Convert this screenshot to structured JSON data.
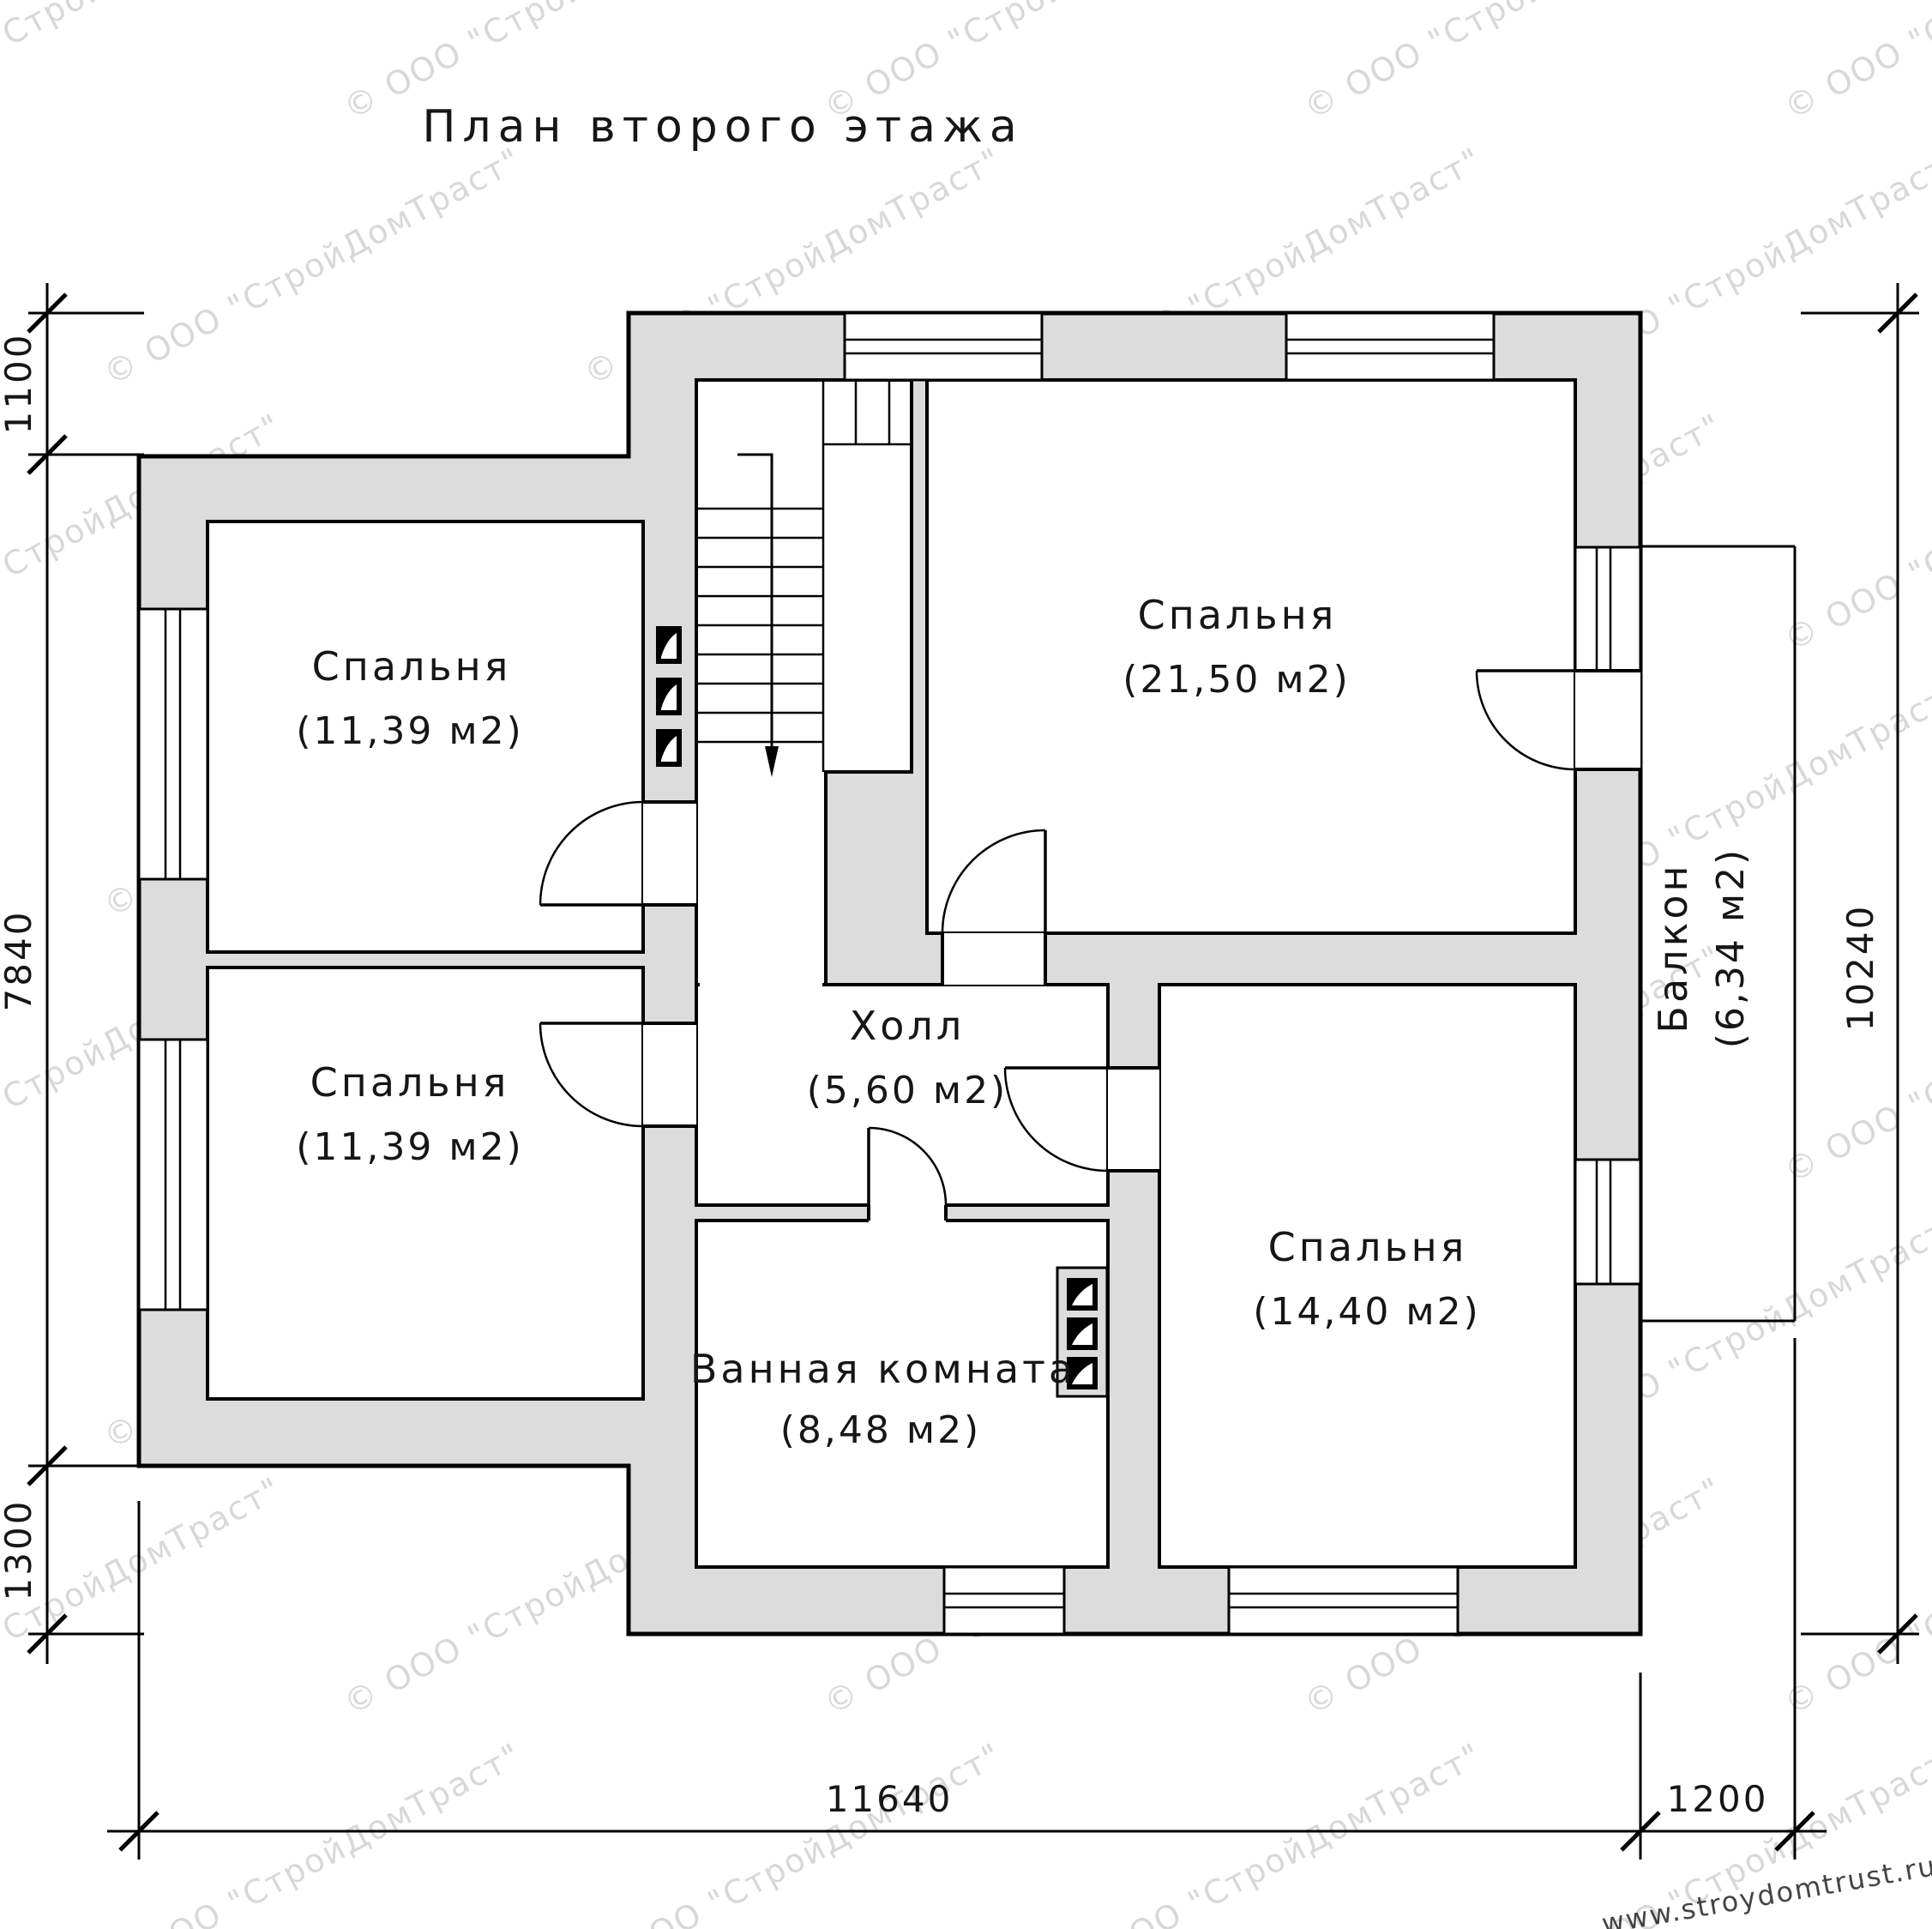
{
  "title": "План второго этажа",
  "watermark": {
    "text": "© ООО \"СтройДомТраст\"",
    "url_text": "www.stroydomtrust.ru"
  },
  "rooms": [
    {
      "name": "Спальня",
      "area": "(11,39 м2)"
    },
    {
      "name": "Спальня",
      "area": "(11,39 м2)"
    },
    {
      "name": "Спальня",
      "area": "(21,50 м2)"
    },
    {
      "name": "Спальня",
      "area": "(14,40 м2)"
    },
    {
      "name": "Холл",
      "area": "(5,60 м2)"
    },
    {
      "name": "Ванная комната",
      "area": "(8,48 м2)"
    },
    {
      "name": "Балкон",
      "area": "(6,34 м2)"
    }
  ],
  "dimensions": {
    "left": [
      "1100",
      "7840",
      "1300"
    ],
    "right": [
      "10240"
    ],
    "bottom": [
      "11640",
      "1200"
    ]
  },
  "colors": {
    "wall_fill": "#dcdcdc",
    "line": "#000000",
    "watermark": "#b9b9b9",
    "url_text_color": "#a3bd3f"
  }
}
